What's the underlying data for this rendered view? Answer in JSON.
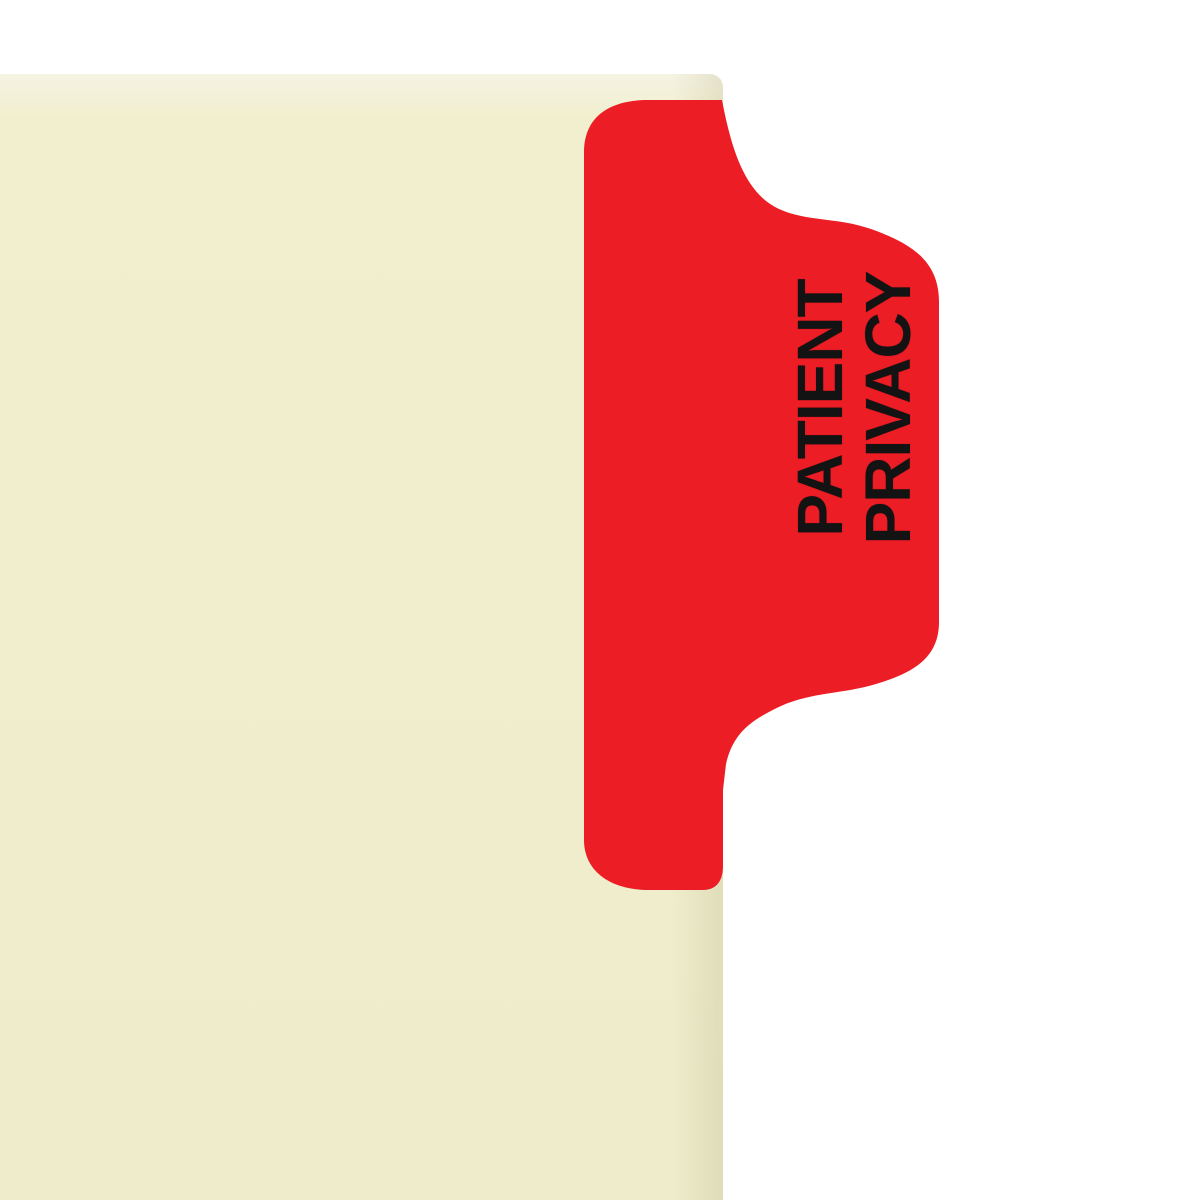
{
  "image": {
    "description": "Manila file folder with a red wrap-around side index tab"
  },
  "colors": {
    "background": "#ffffff",
    "folder_cream": "#f1efce",
    "tab_red": "#ec1d25",
    "label_text": "#131313"
  },
  "tab": {
    "line1": "PATIENT",
    "line2": "PRIVACY"
  }
}
